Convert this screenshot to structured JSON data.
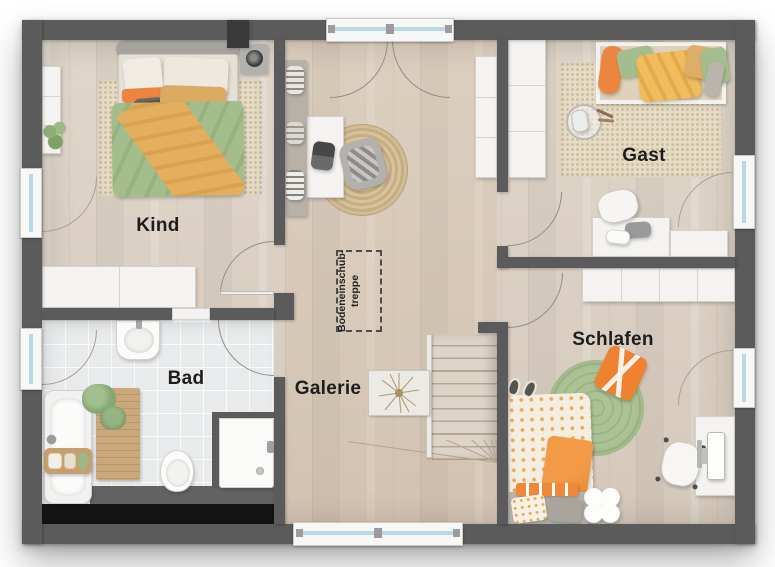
{
  "plan": {
    "type": "floor-plan-upper-storey",
    "rooms": [
      {
        "id": "kind",
        "label": "Kind"
      },
      {
        "id": "gast",
        "label": "Gast"
      },
      {
        "id": "bad",
        "label": "Bad"
      },
      {
        "id": "galerie",
        "label": "Galerie"
      },
      {
        "id": "schlafen",
        "label": "Schlafen"
      }
    ],
    "annotations": {
      "attic_stairs_line1": "Bodeneinschub-",
      "attic_stairs_line2": "treppe"
    },
    "colors": {
      "wall": "#5b5b5b",
      "floor_wood": "#dbd1c5",
      "floor_tile": "#e8eaec",
      "void_black": "#141414",
      "window_glass": "#b9d8e6",
      "door_arc": "#8f8f8f",
      "accent_orange": "#ec8540",
      "accent_green": "#a3bd8c",
      "accent_yellow": "#f0bc5e",
      "rug_beige": "#e6dbc5",
      "rug_green": "#abc294",
      "furniture_white": "#f4f3f1"
    }
  }
}
